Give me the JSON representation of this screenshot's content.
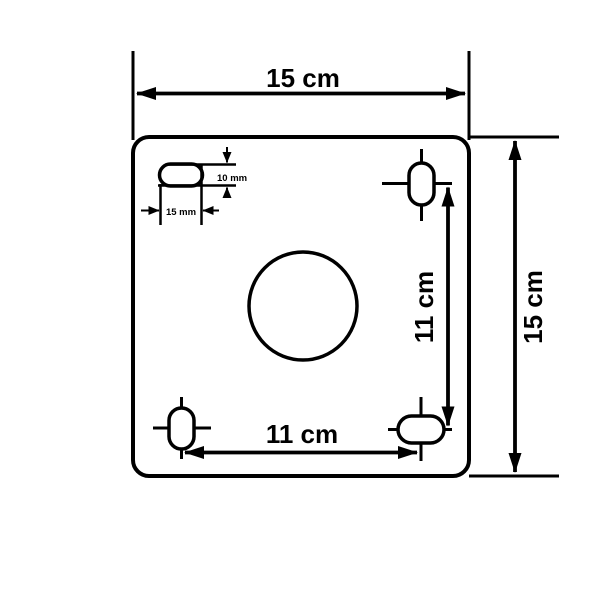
{
  "diagram": {
    "type": "technical-dimension-drawing",
    "subject": "square mounting plate top view",
    "background_color": "#ffffff",
    "line_color": "#000000",
    "labels": {
      "plate_width": "15 cm",
      "plate_height": "15 cm",
      "hole_spacing_vertical": "11 cm",
      "hole_spacing_horizontal": "11 cm",
      "slot_height": "10 mm",
      "slot_width": "15 mm"
    }
  }
}
